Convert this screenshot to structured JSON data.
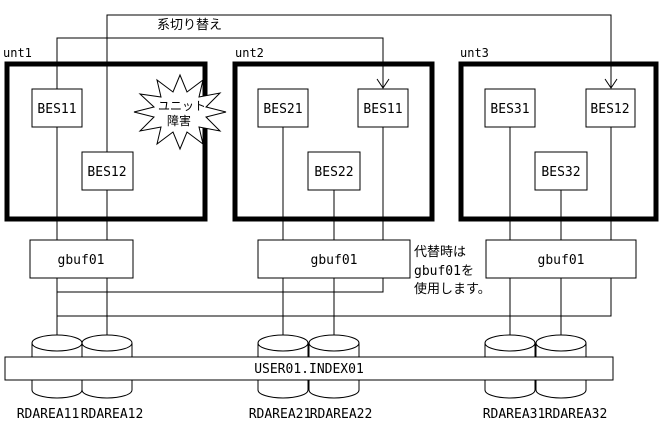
{
  "diagram": {
    "switchover_label": "系切り替え",
    "failure_burst": {
      "line1": "ユニット",
      "line2": "障害"
    },
    "note": {
      "line1": "代替時は",
      "line2": "gbuf01を",
      "line3": "使用します。"
    },
    "units": [
      {
        "label": "unt1",
        "bes": [
          "BES11",
          "BES12"
        ],
        "gbuf_label": "gbuf01",
        "rdareas": [
          "RDAREA11",
          "RDAREA12"
        ]
      },
      {
        "label": "unt2",
        "bes": [
          "BES21",
          "BES11",
          "BES22"
        ],
        "gbuf_label": "gbuf01",
        "rdareas": [
          "RDAREA21",
          "RDAREA22"
        ]
      },
      {
        "label": "unt3",
        "bes": [
          "BES31",
          "BES12",
          "BES32"
        ],
        "gbuf_label": "gbuf01",
        "rdareas": [
          "RDAREA31",
          "RDAREA32"
        ]
      }
    ],
    "shared_index_label": "USER01.INDEX01",
    "colors": {
      "line": "#000000",
      "background": "#ffffff"
    }
  }
}
